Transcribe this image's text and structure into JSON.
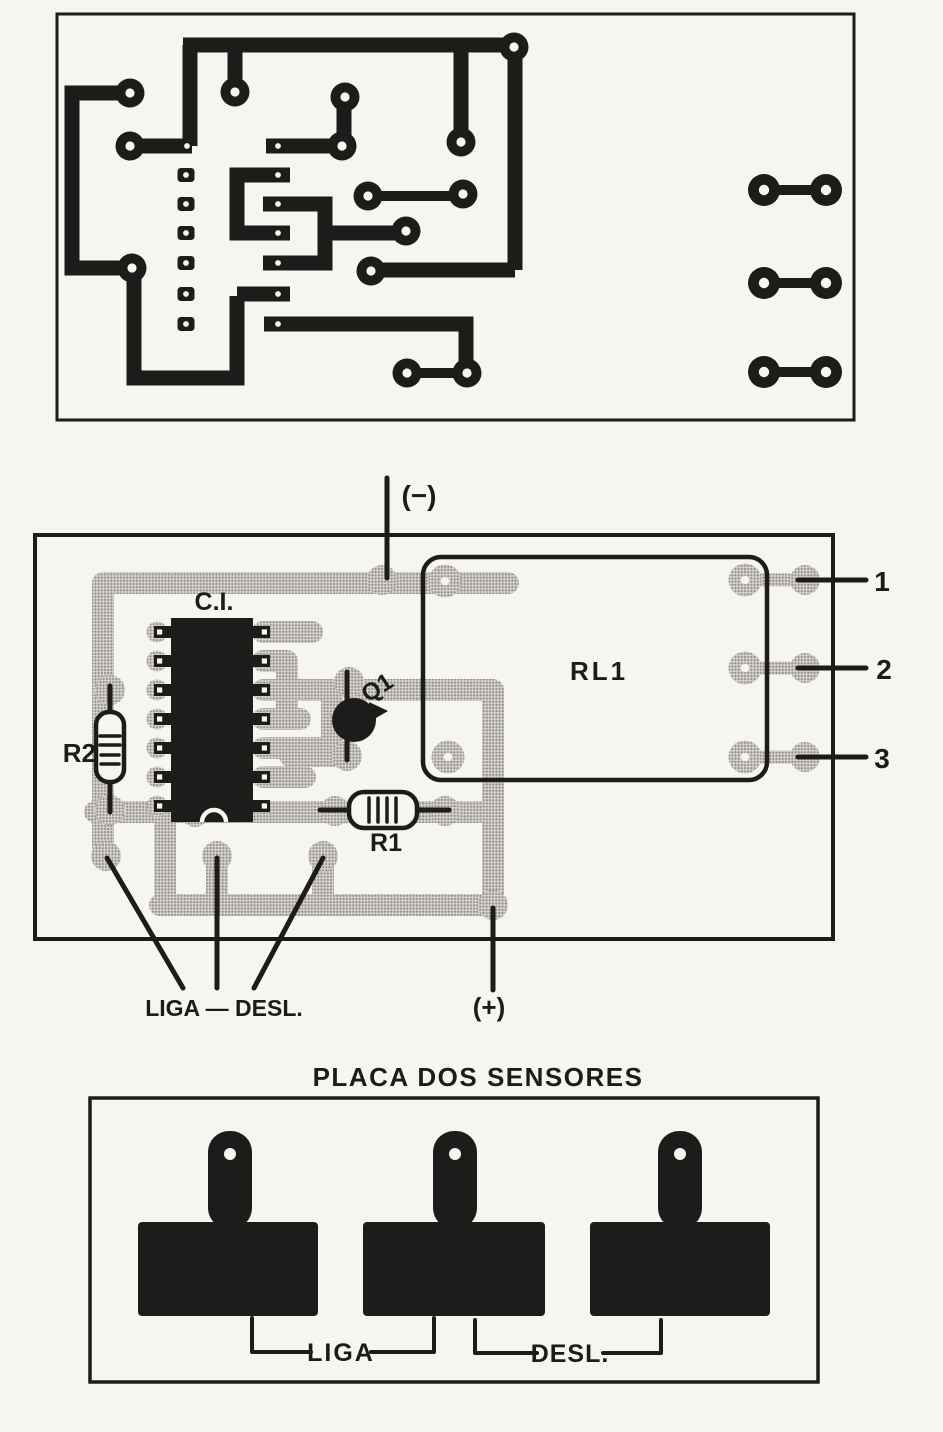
{
  "colors": {
    "ink": "#1d1c1a",
    "paper": "#f6f5f0",
    "halftone_base": "#d8d5cf",
    "halftone_dot": "#8f8d89"
  },
  "component_board": {
    "labels": {
      "negative": "(−)",
      "ic": "C.I.",
      "r2": "R2",
      "q1": "Q1",
      "r1": "R1",
      "relay": "RL1",
      "pin1": "1",
      "pin2": "2",
      "pin3": "3",
      "switch": "LIGA — DESL.",
      "positive": "(+)"
    }
  },
  "sensor_board": {
    "title": "PLACA DOS SENSORES",
    "labels": {
      "on": "LIGA",
      "off": "DESL."
    }
  }
}
